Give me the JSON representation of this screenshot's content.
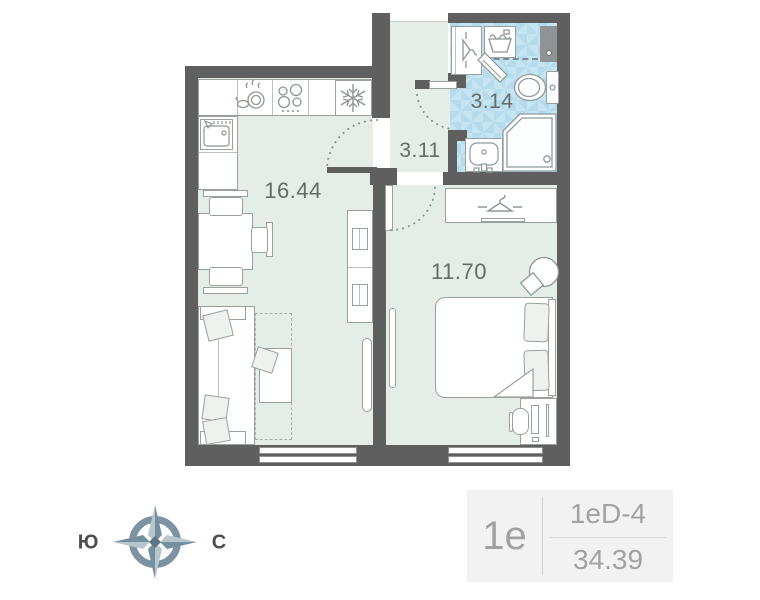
{
  "plan": {
    "rooms": [
      {
        "name": "kitchen-living-room",
        "label": "16.44"
      },
      {
        "name": "hallway",
        "label": "3.11"
      },
      {
        "name": "bathroom",
        "label": "3.14"
      },
      {
        "name": "bedroom",
        "label": "11.70"
      }
    ],
    "icons": {
      "fridge": "snowflake-icon",
      "stove": "burners-icon",
      "dishwasher": "dishes-drops-icon",
      "kitchen_sink": "sink-faucet-icon",
      "wardrobe": "hanger-icon",
      "entry_closet": "hanger-icon",
      "laundry": "washing-basin-icon",
      "wc": "toilet-icon",
      "bath_sink": "washbasin-icon",
      "shower": "corner-shower-icon"
    }
  },
  "compass": {
    "south_label": "Ю",
    "north_label": "С"
  },
  "legend": {
    "layout_code": "1е",
    "plan_name": "1eD-4",
    "total_area": "34.39"
  },
  "colors": {
    "wall": "#5f5f5f",
    "room_fill": "#e5eee6",
    "bath_fill": "#b5dcec",
    "bath_fill_light": "#c7e4f1",
    "furniture_stroke": "#98a29b",
    "label_text": "#636d66",
    "legend_text": "#a2a2a2",
    "legend_bg": "#f2f2f2",
    "compass_dark": "#74909f",
    "compass_light": "#b7c5cd"
  }
}
